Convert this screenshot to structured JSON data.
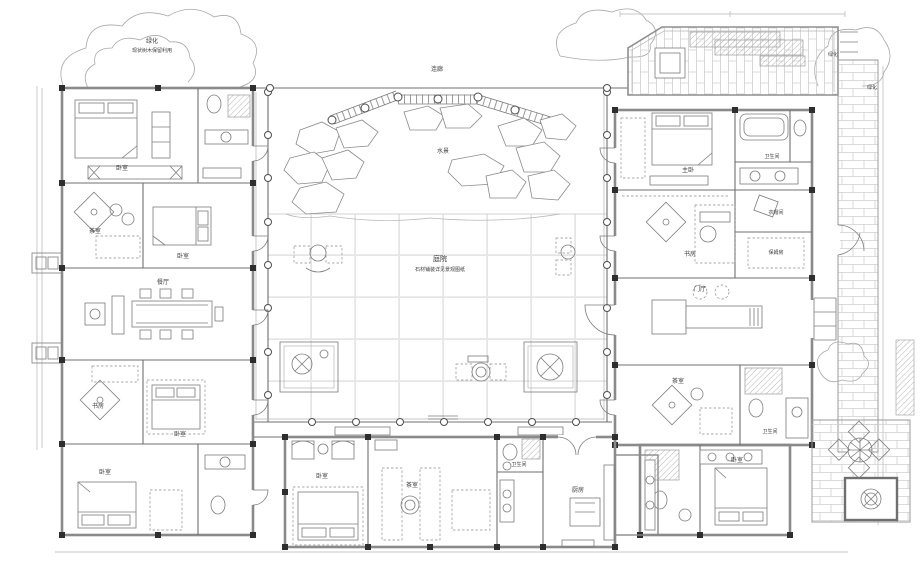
{
  "plan": {
    "title": "中式合院别墅一层平面图",
    "colors": {
      "paper": "#ffffff",
      "wall": "#8a8a8a",
      "partition": "#6f6f6f",
      "furniture": "#7c7c7c",
      "grid_joint": "#d8d8d8",
      "brick": "#cfcfcf",
      "label_text": "#3c3c3c"
    },
    "legend": {
      "courtyard_label": "庭院",
      "courtyard_note": "石材铺装详见景观图纸",
      "water_feature": "水景",
      "corridor": "连廊",
      "greenery": "绿化"
    },
    "labels": [
      {
        "text": "绿化",
        "x": 152,
        "y": 43,
        "s": 6
      },
      {
        "text": "现状树木保留利用",
        "x": 152,
        "y": 52,
        "s": 5
      },
      {
        "text": "连廊",
        "x": 437,
        "y": 71,
        "s": 6
      },
      {
        "text": "水景",
        "x": 443,
        "y": 153,
        "s": 6
      },
      {
        "text": "庭院",
        "x": 440,
        "y": 261,
        "s": 7
      },
      {
        "text": "石材铺装详见景观图纸",
        "x": 440,
        "y": 271,
        "s": 5
      },
      {
        "text": "卧室",
        "x": 122,
        "y": 170,
        "s": 6
      },
      {
        "text": "茶室",
        "x": 95,
        "y": 233,
        "s": 6
      },
      {
        "text": "卧室",
        "x": 183,
        "y": 258,
        "s": 6
      },
      {
        "text": "餐厅",
        "x": 163,
        "y": 284,
        "s": 6
      },
      {
        "text": "书房",
        "x": 98,
        "y": 408,
        "s": 6
      },
      {
        "text": "卧室",
        "x": 180,
        "y": 436,
        "s": 6
      },
      {
        "text": "卧室",
        "x": 105,
        "y": 474,
        "s": 6
      },
      {
        "text": "主卧",
        "x": 688,
        "y": 172,
        "s": 6
      },
      {
        "text": "卫生间",
        "x": 772,
        "y": 158,
        "s": 5
      },
      {
        "text": "书房",
        "x": 690,
        "y": 256,
        "s": 6
      },
      {
        "text": "衣帽间",
        "x": 776,
        "y": 214,
        "s": 5
      },
      {
        "text": "保姆房",
        "x": 776,
        "y": 254,
        "s": 5
      },
      {
        "text": "门厅",
        "x": 700,
        "y": 291,
        "s": 6
      },
      {
        "text": "茶室",
        "x": 678,
        "y": 383,
        "s": 6
      },
      {
        "text": "卫生间",
        "x": 770,
        "y": 433,
        "s": 5
      },
      {
        "text": "卧室",
        "x": 737,
        "y": 462,
        "s": 6
      },
      {
        "text": "卧室",
        "x": 322,
        "y": 478,
        "s": 6
      },
      {
        "text": "茶室",
        "x": 412,
        "y": 487,
        "s": 6
      },
      {
        "text": "厨房",
        "x": 578,
        "y": 492,
        "s": 6
      },
      {
        "text": "卫生间",
        "x": 519,
        "y": 466,
        "s": 5
      },
      {
        "text": "绿化",
        "x": 833,
        "y": 56,
        "s": 5
      },
      {
        "text": "绿化",
        "x": 872,
        "y": 89,
        "s": 5
      }
    ]
  }
}
